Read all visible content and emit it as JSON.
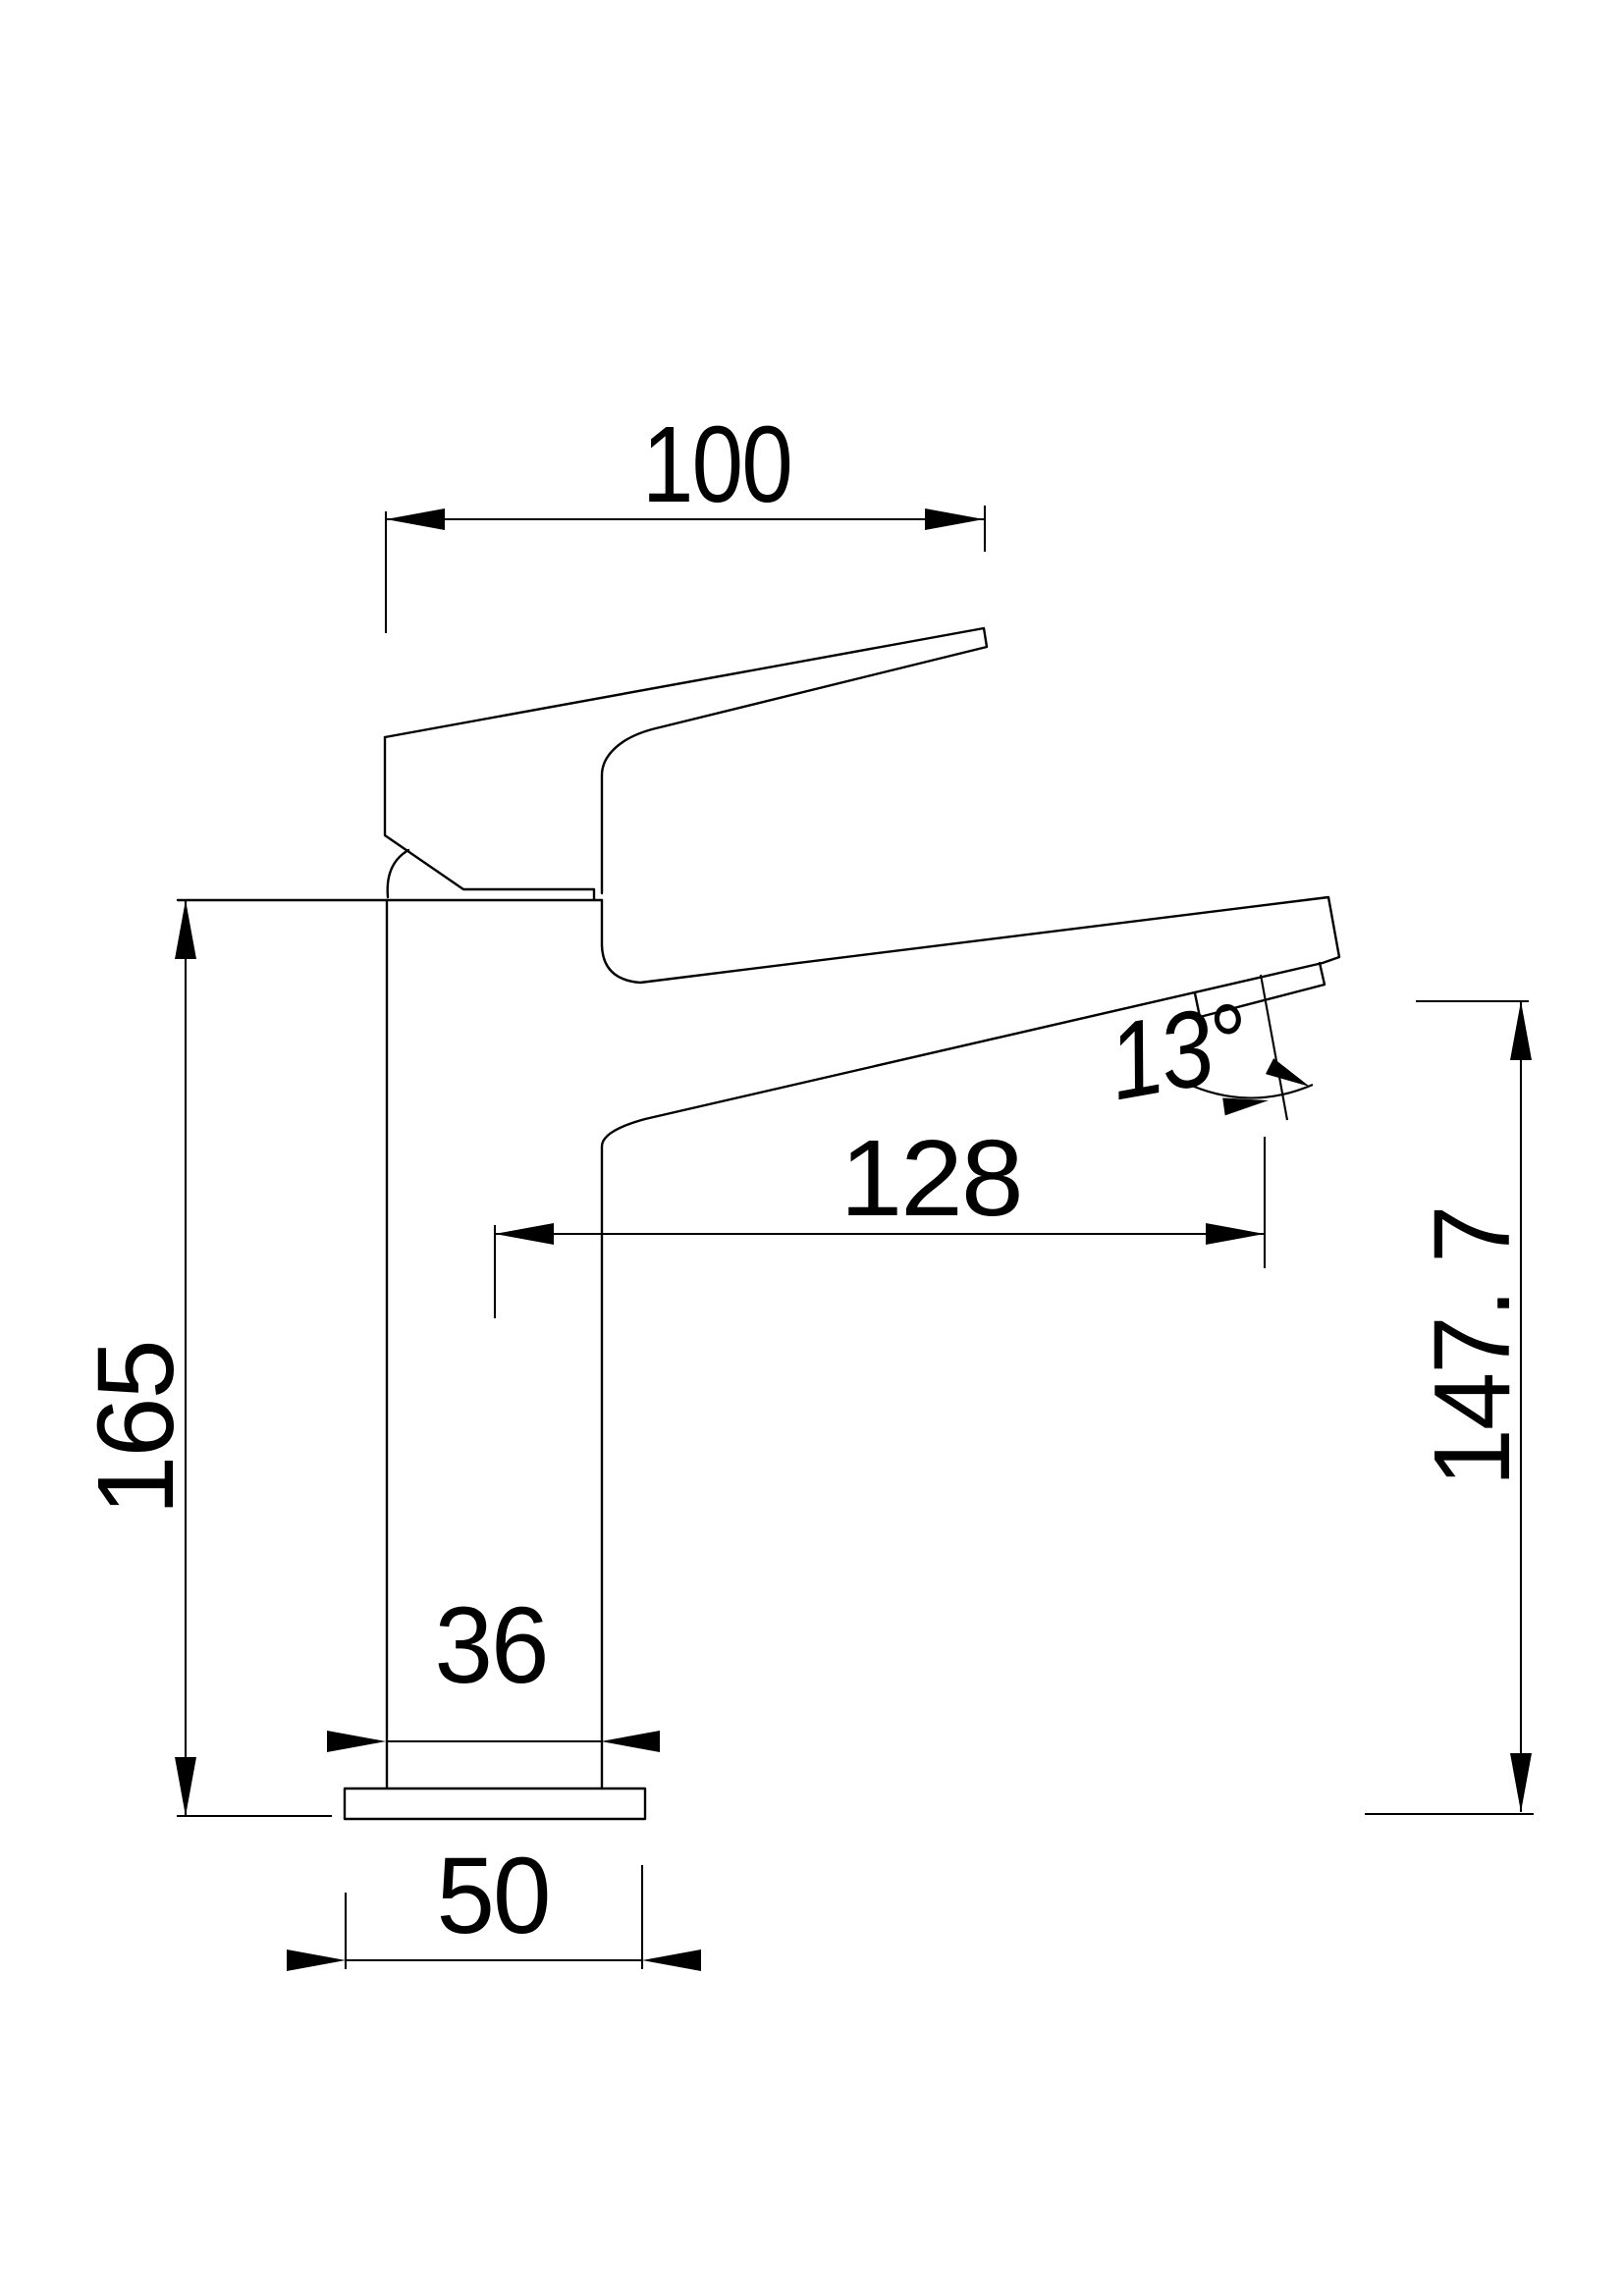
{
  "drawing": {
    "type": "faucet-side-elevation",
    "colors": {
      "line": "#000000",
      "background": "#ffffff"
    },
    "dimensions": {
      "handle_length": {
        "label": "100"
      },
      "total_height": {
        "label": "165"
      },
      "spout_reach": {
        "label": "128"
      },
      "outlet_angle": {
        "label": "13°"
      },
      "outlet_height": {
        "label": "147. 7"
      },
      "body_width": {
        "label": "36"
      },
      "base_width": {
        "label": "50"
      }
    }
  }
}
